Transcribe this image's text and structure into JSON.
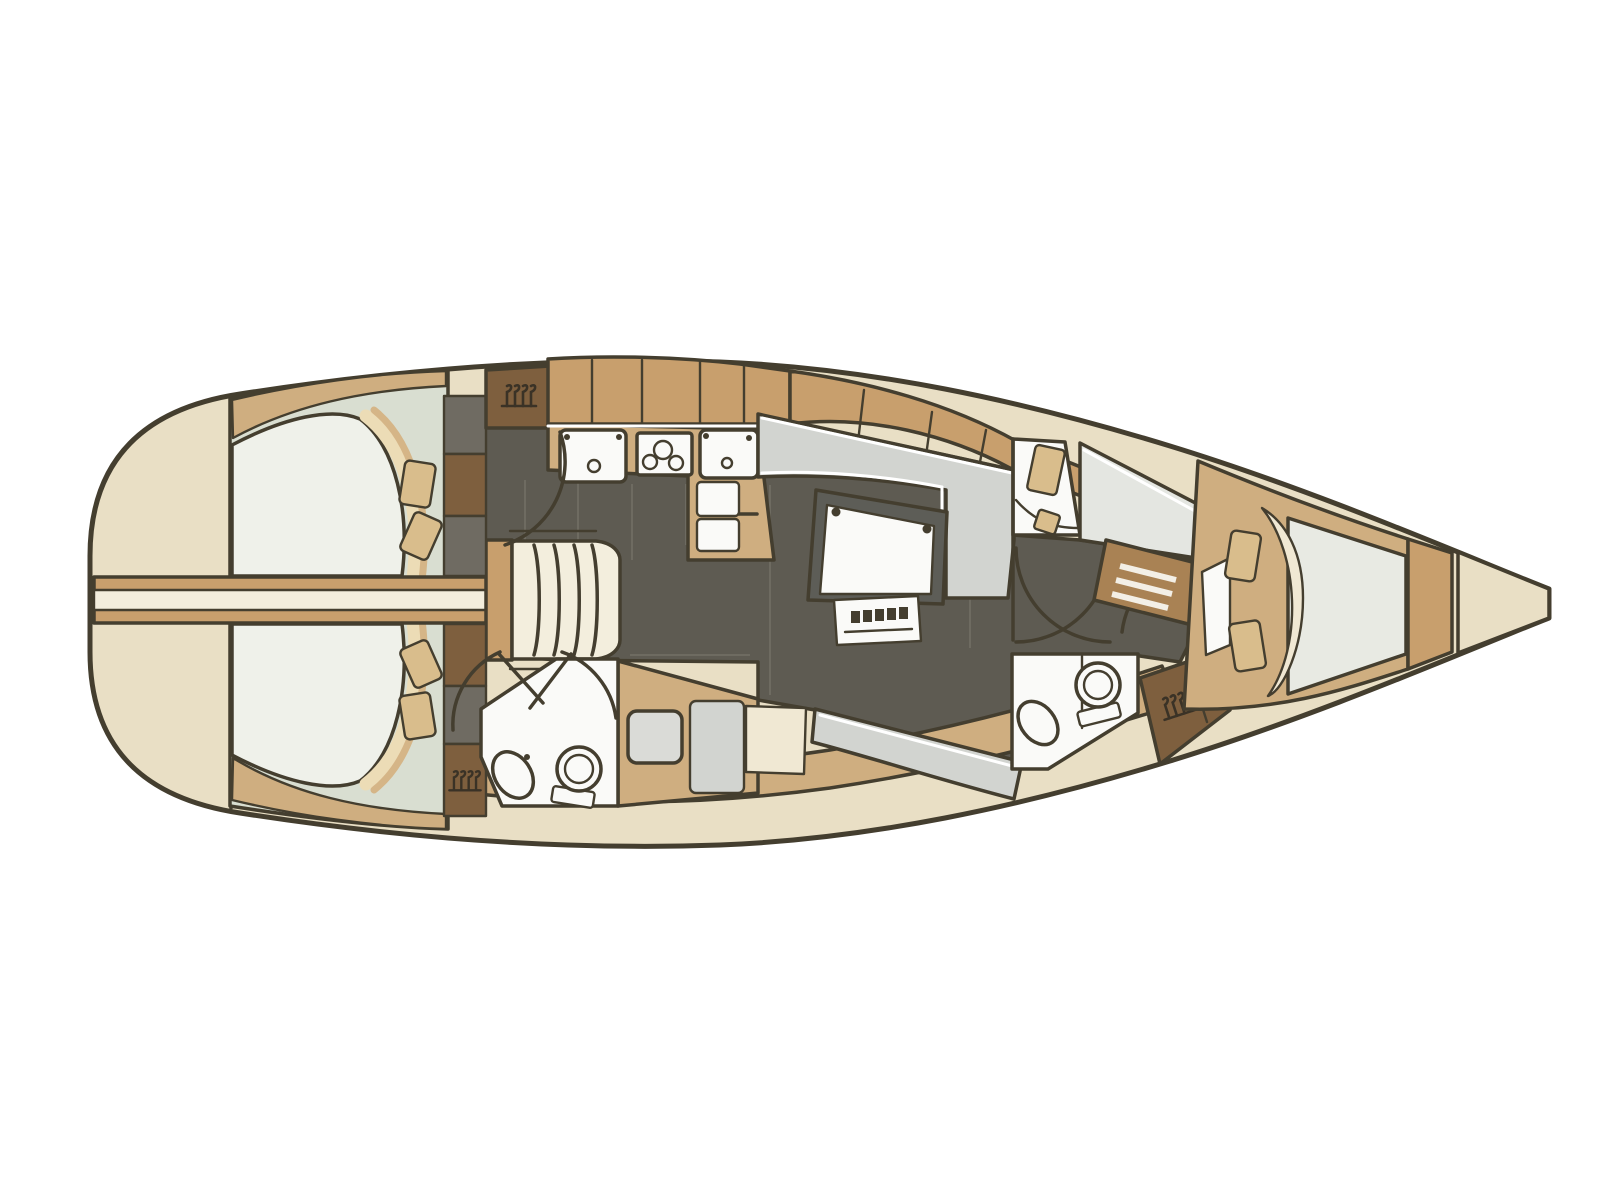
{
  "meta": {
    "title": "Sailing yacht interior layout plan (top view, bow to the right)",
    "type": "boat-floor-plan",
    "orientation": "bow-right"
  },
  "palette": {
    "bg": "#ffffff",
    "line": "#443e2f",
    "icon_dark": "#3a3226",
    "hull": "#e9dfc5",
    "wood": "#c89f6d",
    "counter": "#cfae80",
    "wood_dark": "#7e5f3e",
    "drawer_wood": "#a98254",
    "locker_gray": "#6f6b62",
    "floor_dark": "#5e5b52",
    "floor_grid": "#8a867a",
    "cabin_floor": "#d9ded1",
    "mattress": "#eff1ea",
    "mattress_fwd": "#e8eae3",
    "seat_gray": "#d2d4d0",
    "berth_light": "#e4e6e1",
    "fixture_white": "#fafaf8",
    "cream": "#f0e8d3",
    "beam_cream": "#f3eedd",
    "pillow": "#d9bd8c",
    "band_cream": "#ecdcb6",
    "band_tan": "#d5b587",
    "table_frame": "#5d5d57",
    "vanity_gray": "#dadbd7"
  },
  "icons": {
    "hanger-icon": "clothes hangers hanging on a rail",
    "toilet-icon": "round bowl with seat ring and tank",
    "sink-icon": "oval wash basin",
    "stove-icon": "three burner circles on a hob",
    "fridge-icon": "two top-opening lids with handle",
    "stairs-icon": "companionway steps",
    "door-arc-icon": "quarter-circle door swing"
  },
  "rooms": [
    "aft-owner-cabin",
    "companionway",
    "port-galley",
    "salon",
    "aft-head",
    "forward-head",
    "corridor",
    "forward-compartment",
    "forward-v-berth-cabin",
    "bow-anchor-locker"
  ]
}
